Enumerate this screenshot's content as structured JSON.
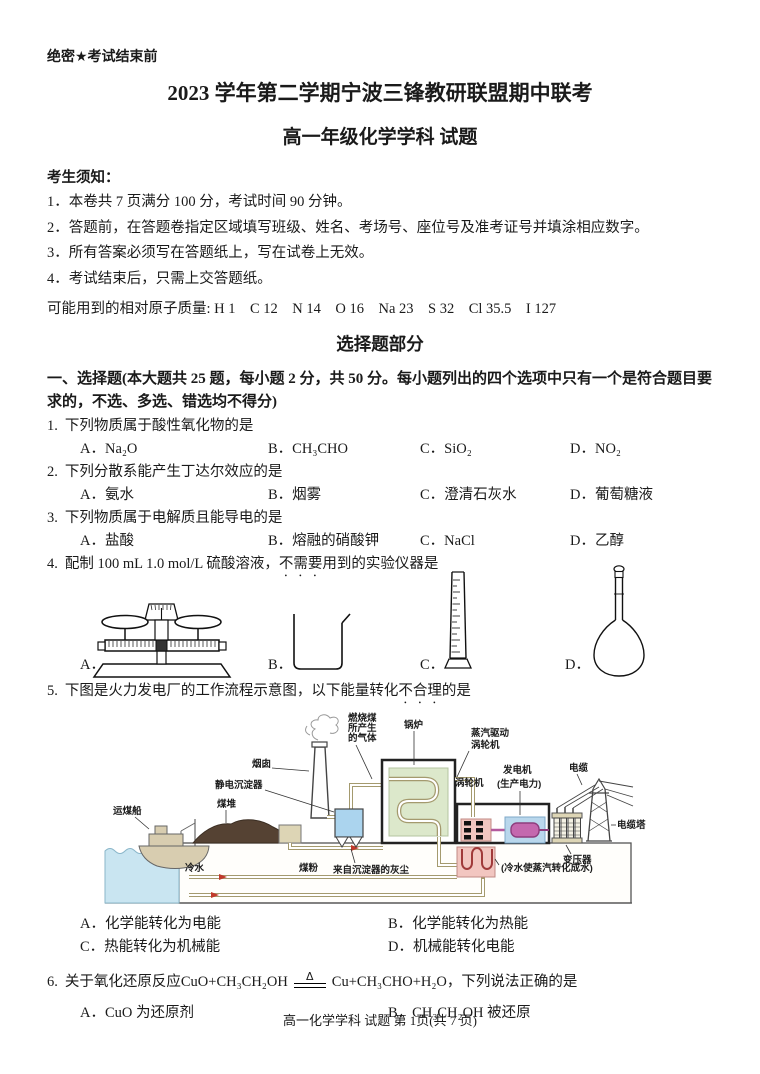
{
  "page": {
    "classification": "绝密★考试结束前",
    "title": "2023 学年第二学期宁波三锋教研联盟期中联考",
    "subtitle": "高一年级化学学科 试题",
    "footer": "高一化学学科 试题 第 1页(共 7 页)"
  },
  "notice": {
    "heading": "考生须知：",
    "items": [
      "1．本卷共 7 页满分 100 分，考试时间 90 分钟。",
      "2．答题前，在答题卷指定区域填写班级、姓名、考场号、座位号及准考证号并填涂相应数字。",
      "3．所有答案必须写在答题纸上，写在试卷上无效。",
      "4．考试结束后，只需上交答题纸。"
    ]
  },
  "atomic_mass_line": "可能用到的相对原子质量: H 1    C 12    N 14    O 16    Na 23    S 32    Cl 35.5    I 127",
  "section": {
    "part_title": "选择题部分",
    "instructions": "一、选择题(本大题共 25 题，每小题 2 分，共 50 分。每小题列出的四个选项中只有一个是符合题目要求的，不选、多选、错选均不得分)"
  },
  "questions": {
    "q1": {
      "number": "1.",
      "text": "下列物质属于酸性氧化物的是",
      "options": [
        "A．Na₂O",
        "B．CH₃CHO",
        "C．SiO₂",
        "D．NO₂"
      ]
    },
    "q2": {
      "number": "2.",
      "text": "下列分散系能产生丁达尔效应的是",
      "options": [
        "A．氨水",
        "B．烟雾",
        "C．澄清石灰水",
        "D．葡萄糖液"
      ]
    },
    "q3": {
      "number": "3.",
      "text": "下列物质属于电解质且能导电的是",
      "options": [
        "A．盐酸",
        "B．熔融的硝酸钾",
        "C．NaCl",
        "D．乙醇"
      ]
    },
    "q4": {
      "number": "4.",
      "text_before": "配制 100 mL 1.0 mol/L 硫酸溶液，",
      "emphasis": "不需要",
      "text_after": "用到的实验仪器是",
      "labels": [
        "A．",
        "B．",
        "C．",
        "D．"
      ],
      "apparatus_icons": [
        "balance-icon",
        "beaker-icon",
        "measuring-cylinder-icon",
        "volumetric-flask-icon"
      ]
    },
    "q5": {
      "number": "5.",
      "text_before": "下图是火力发电厂的工作流程示意图，以下能量转化",
      "emphasis": "不合理",
      "text_after": "的是",
      "options": [
        "A．化学能转化为电能",
        "B．化学能转化为热能",
        "C．热能转化为机械能",
        "D．机械能转化电能"
      ]
    },
    "q6": {
      "number": "6.",
      "text_before": "关于氧化还原反应 ",
      "lhs": "CuO+CH₃CH₂OH",
      "condition": "Δ",
      "rhs": "Cu+CH₃CHO+H₂O",
      "text_after": "，下列说法正确的是",
      "options": [
        "A．CuO 为还原剂",
        "B．CH₃CH₂OH 被还原"
      ]
    }
  },
  "diagram": {
    "labels": {
      "gas1": "燃烧煤",
      "gas2": "所产生",
      "gas3": "的气体",
      "boiler": "锅炉",
      "steam1": "蒸汽驱动",
      "steam2": "涡轮机",
      "chimney": "烟囱",
      "precipitator": "静电沉淀器",
      "turbine": "涡轮机",
      "generator": "发电机",
      "generator2": "(生产电力)",
      "cable": "电缆",
      "ship": "运煤船",
      "coalpile": "煤堆",
      "tower": "电缆塔",
      "transformer": "变压器",
      "coldwater": "冷水",
      "coalpowder": "煤粉",
      "ash": "来自沉淀器的灰尘",
      "condenser": "(冷水使蒸汽转化成水)"
    },
    "colors": {
      "water": "#c9e5f1",
      "ship": "#d8cdb0",
      "coal": "#554233",
      "precipitator_blue": "#abd4ee",
      "boiler_green": "#dce8cb",
      "turbine_pink": "#f2c6c0",
      "generator_blue": "#b9d7ec",
      "generator_magenta": "#c468ae",
      "pipe_tan": "#a49a6e",
      "arrow_red": "#c0392b"
    }
  }
}
